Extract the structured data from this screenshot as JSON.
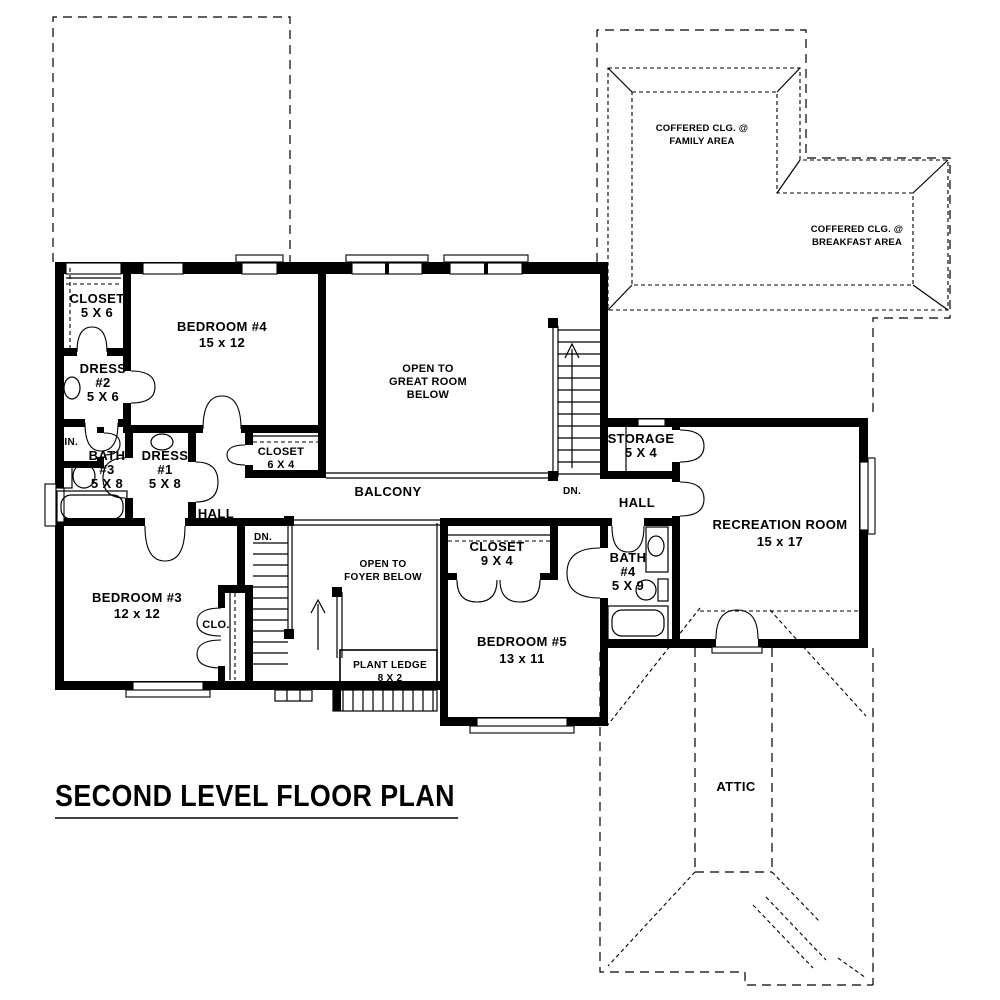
{
  "page": {
    "background": "#ffffff",
    "line_color": "#000000"
  },
  "title": {
    "text": "SECOND LEVEL FLOOR PLAN"
  },
  "rooms": {
    "closet_b4": {
      "name": "CLOSET",
      "size": "5 X 6"
    },
    "bedroom4": {
      "name": "BEDROOM #4",
      "size": "15 x 12"
    },
    "dress2": {
      "name": "DRESS",
      "number": "#2",
      "size": "5 X 6"
    },
    "linen": {
      "name": "LIN."
    },
    "bath3": {
      "name": "BATH",
      "number": "#3",
      "size": "5 X 8"
    },
    "dress1": {
      "name": "DRESS",
      "number": "#1",
      "size": "5 X 8"
    },
    "closet_hall": {
      "name": "CLOSET",
      "size": "6 X 4"
    },
    "open_great": {
      "line1": "OPEN TO",
      "line2": "GREAT ROOM",
      "line3": "BELOW"
    },
    "balcony": {
      "name": "BALCONY"
    },
    "hall_west": {
      "name": "HALL"
    },
    "hall_east": {
      "name": "HALL"
    },
    "storage": {
      "name": "STORAGE",
      "size": "5 X 4"
    },
    "open_foyer": {
      "line1": "OPEN TO",
      "line2": "FOYER BELOW"
    },
    "plant_ledge": {
      "name": "PLANT LEDGE",
      "size": "8 X 2"
    },
    "bedroom3": {
      "name": "BEDROOM #3",
      "size": "12 x 12"
    },
    "clo": {
      "name": "CLO."
    },
    "closet_b5": {
      "name": "CLOSET",
      "size": "9 X 4"
    },
    "bedroom5": {
      "name": "BEDROOM #5",
      "size": "13 x 11"
    },
    "bath4": {
      "name": "BATH",
      "number": "#4",
      "size": "5 X 9"
    },
    "recreation": {
      "name": "RECREATION ROOM",
      "size": "15 x 17"
    },
    "attic": {
      "name": "ATTIC"
    }
  },
  "ceiling_notes": {
    "family": {
      "line1": "COFFERED CLG. @",
      "line2": "FAMILY AREA"
    },
    "breakfast": {
      "line1": "COFFERED CLG. @",
      "line2": "BREAKFAST AREA"
    }
  },
  "stairs": {
    "down_label_main": "DN.",
    "down_label_foyer": "DN."
  }
}
